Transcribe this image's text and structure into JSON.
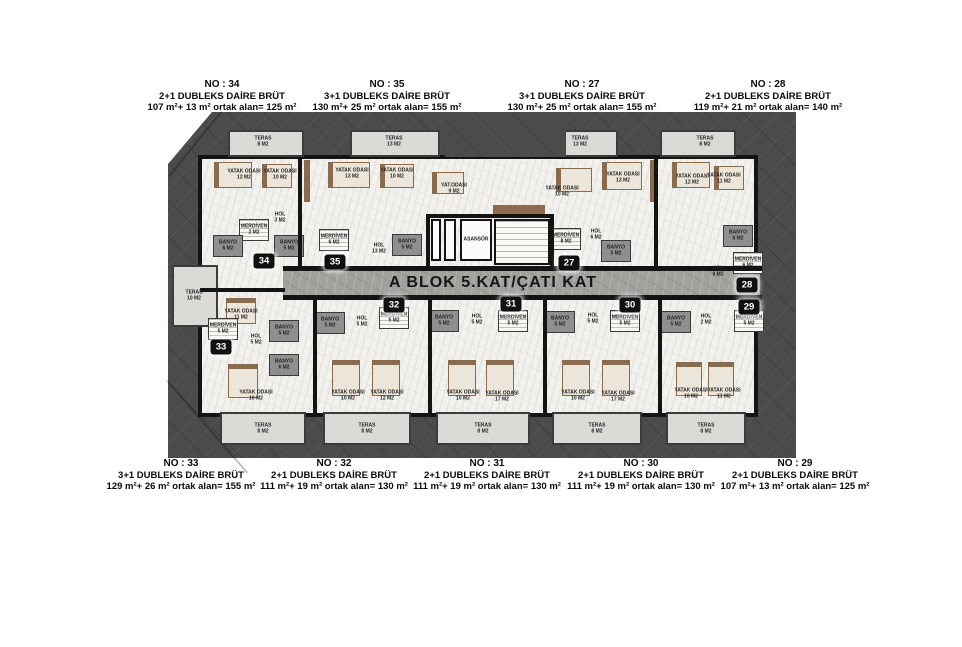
{
  "title": "A BLOK 5.KAT/ÇATI KAT",
  "units_top": [
    {
      "no": "NO : 34",
      "type": "2+1 DUBLEKS DAİRE BRÜT",
      "area": "107 m²+ 13 m² ortak alan= 125 m²",
      "cx": 222
    },
    {
      "no": "NO : 35",
      "type": "3+1 DUBLEKS DAİRE BRÜT",
      "area": "130 m²+ 25 m² ortak alan= 155 m²",
      "cx": 387
    },
    {
      "no": "NO : 27",
      "type": "3+1 DUBLEKS DAİRE BRÜT",
      "area": "130 m²+ 25 m² ortak alan= 155 m²",
      "cx": 582
    },
    {
      "no": "NO : 28",
      "type": "2+1 DUBLEKS DAİRE BRÜT",
      "area": "119 m²+ 21 m² ortak alan= 140 m²",
      "cx": 768
    }
  ],
  "units_bottom": [
    {
      "no": "NO : 33",
      "type": "3+1 DUBLEKS DAİRE BRÜT",
      "area": "129 m²+ 26 m² ortak alan= 155 m²",
      "cx": 181
    },
    {
      "no": "NO : 32",
      "type": "2+1 DUBLEKS DAİRE BRÜT",
      "area": "111 m²+ 19 m² ortak alan= 130 m²",
      "cx": 334
    },
    {
      "no": "NO : 31",
      "type": "2+1 DUBLEKS DAİRE BRÜT",
      "area": "111 m²+ 19 m² ortak alan= 130 m²",
      "cx": 487
    },
    {
      "no": "NO : 30",
      "type": "2+1 DUBLEKS DAİRE BRÜT",
      "area": "111 m²+ 19 m² ortak alan= 130 m²",
      "cx": 641
    },
    {
      "no": "NO : 29",
      "type": "2+1 DUBLEKS DAİRE BRÜT",
      "area": "107 m²+ 13 m² ortak alan= 125 m²",
      "cx": 795
    }
  ],
  "badges": [
    {
      "label": "34",
      "x": 96,
      "y": 149
    },
    {
      "label": "35",
      "x": 167,
      "y": 150
    },
    {
      "label": "27",
      "x": 401,
      "y": 151
    },
    {
      "label": "28",
      "x": 579,
      "y": 173
    },
    {
      "label": "29",
      "x": 581,
      "y": 195
    },
    {
      "label": "30",
      "x": 462,
      "y": 193
    },
    {
      "label": "31",
      "x": 343,
      "y": 192
    },
    {
      "label": "32",
      "x": 226,
      "y": 193
    },
    {
      "label": "33",
      "x": 53,
      "y": 235
    }
  ],
  "rooms": [
    {
      "n": "TERAS",
      "a": "8 M2",
      "x": 95,
      "y": 30
    },
    {
      "n": "YATAK ODASI",
      "a": "12 M2",
      "x": 76,
      "y": 63
    },
    {
      "n": "YATAK ODASI",
      "a": "10 M2",
      "x": 112,
      "y": 63
    },
    {
      "n": "HOL",
      "a": "3 M2",
      "x": 112,
      "y": 106
    },
    {
      "n": "MERDİVEN",
      "a": "2 M2",
      "x": 86,
      "y": 118
    },
    {
      "n": "BANYO",
      "a": "6 M2",
      "x": 60,
      "y": 134
    },
    {
      "n": "BANYO",
      "a": "5 M2",
      "x": 121,
      "y": 134
    },
    {
      "n": "TERAS",
      "a": "13 M2",
      "x": 226,
      "y": 30
    },
    {
      "n": "YATAK ODASI",
      "a": "13 M2",
      "x": 184,
      "y": 62
    },
    {
      "n": "YATAK ODASI",
      "a": "10 M2",
      "x": 229,
      "y": 62
    },
    {
      "n": "YAT.ODASI",
      "a": "9 M2",
      "x": 286,
      "y": 77
    },
    {
      "n": "MERDİVEN",
      "a": "6 M2",
      "x": 166,
      "y": 128
    },
    {
      "n": "HOL",
      "a": "13 M2",
      "x": 211,
      "y": 137
    },
    {
      "n": "BANYO",
      "a": "5 M2",
      "x": 239,
      "y": 133
    },
    {
      "n": "ASANSÖR",
      "a": "",
      "x": 308,
      "y": 128
    },
    {
      "n": "MERDİVEN",
      "a": "8 M2",
      "x": 398,
      "y": 127
    },
    {
      "n": "TERAS",
      "a": "13 M2",
      "x": 412,
      "y": 30
    },
    {
      "n": "YATAK ODASI",
      "a": "10 M2",
      "x": 394,
      "y": 80
    },
    {
      "n": "YATAK ODASI",
      "a": "13 M2",
      "x": 455,
      "y": 66
    },
    {
      "n": "HOL",
      "a": "6 M2",
      "x": 428,
      "y": 123
    },
    {
      "n": "BANYO",
      "a": "5 M2",
      "x": 448,
      "y": 139
    },
    {
      "n": "TERAS",
      "a": "8 M2",
      "x": 537,
      "y": 30
    },
    {
      "n": "YATAK ODASI",
      "a": "12 M2",
      "x": 524,
      "y": 68
    },
    {
      "n": "YATAK ODASI",
      "a": "11 M2",
      "x": 556,
      "y": 67
    },
    {
      "n": "BANYO",
      "a": "6 M2",
      "x": 570,
      "y": 124
    },
    {
      "n": "HOL",
      "a": "8 M2",
      "x": 550,
      "y": 160
    },
    {
      "n": "MERDİVEN",
      "a": "6 M2",
      "x": 580,
      "y": 151
    },
    {
      "n": "MERDİVEN",
      "a": "5 M2",
      "x": 581,
      "y": 209
    },
    {
      "n": "HOL",
      "a": "2 M2",
      "x": 538,
      "y": 208
    },
    {
      "n": "BANYO",
      "a": "5 M2",
      "x": 508,
      "y": 210
    },
    {
      "n": "YATAK ODASI",
      "a": "10 M2",
      "x": 523,
      "y": 282
    },
    {
      "n": "YATAK ODASI",
      "a": "11 M2",
      "x": 556,
      "y": 282
    },
    {
      "n": "TERAS",
      "a": "8 M2",
      "x": 538,
      "y": 317
    },
    {
      "n": "MERDİVEN",
      "a": "5 M2",
      "x": 457,
      "y": 209
    },
    {
      "n": "HOL",
      "a": "5 M2",
      "x": 425,
      "y": 207
    },
    {
      "n": "BANYO",
      "a": "5 M2",
      "x": 392,
      "y": 210
    },
    {
      "n": "YATAK ODASI",
      "a": "10 M2",
      "x": 410,
      "y": 284
    },
    {
      "n": "YATAK ODASI",
      "a": "17 M2",
      "x": 450,
      "y": 285
    },
    {
      "n": "TERAS",
      "a": "8 M2",
      "x": 429,
      "y": 317
    },
    {
      "n": "MERDİVEN",
      "a": "5 M2",
      "x": 345,
      "y": 209
    },
    {
      "n": "HOL",
      "a": "5 M2",
      "x": 309,
      "y": 208
    },
    {
      "n": "BANYO",
      "a": "5 M2",
      "x": 276,
      "y": 209
    },
    {
      "n": "YATAK ODASI",
      "a": "10 M2",
      "x": 295,
      "y": 284
    },
    {
      "n": "YATAK ODASI",
      "a": "17 M2",
      "x": 334,
      "y": 285
    },
    {
      "n": "TERAS",
      "a": "8 M2",
      "x": 315,
      "y": 317
    },
    {
      "n": "MERDİVEN",
      "a": "5 M2",
      "x": 226,
      "y": 206
    },
    {
      "n": "HOL",
      "a": "5 M2",
      "x": 194,
      "y": 210
    },
    {
      "n": "BANYO",
      "a": "5 M2",
      "x": 162,
      "y": 211
    },
    {
      "n": "YATAK ODASI",
      "a": "10 M2",
      "x": 180,
      "y": 284
    },
    {
      "n": "YATAK ODASI",
      "a": "12 M2",
      "x": 219,
      "y": 284
    },
    {
      "n": "TERAS",
      "a": "8 M2",
      "x": 199,
      "y": 317
    },
    {
      "n": "TERAS",
      "a": "10 M2",
      "x": 26,
      "y": 184
    },
    {
      "n": "YATAK ODASI",
      "a": "11 M2",
      "x": 73,
      "y": 203
    },
    {
      "n": "MERDİVEN",
      "a": "5 M2",
      "x": 55,
      "y": 217
    },
    {
      "n": "HOL",
      "a": "5 M2",
      "x": 88,
      "y": 228
    },
    {
      "n": "BANYO",
      "a": "5 M2",
      "x": 116,
      "y": 219
    },
    {
      "n": "BANYO",
      "a": "6 M2",
      "x": 116,
      "y": 253
    },
    {
      "n": "YATAK ODASI",
      "a": "10 M2",
      "x": 88,
      "y": 284
    },
    {
      "n": "TERAS",
      "a": "8 M2",
      "x": 95,
      "y": 317
    }
  ],
  "areas": [
    {
      "t": "terrace",
      "x": 60,
      "y": 18,
      "w": 76,
      "h": 27
    },
    {
      "t": "terrace",
      "x": 182,
      "y": 18,
      "w": 90,
      "h": 27
    },
    {
      "t": "terrace",
      "x": 377,
      "y": 18,
      "w": 73,
      "h": 27
    },
    {
      "t": "terrace",
      "x": 492,
      "y": 18,
      "w": 76,
      "h": 27
    },
    {
      "t": "terrace",
      "x": 4,
      "y": 153,
      "w": 46,
      "h": 62
    },
    {
      "t": "terrace",
      "x": 52,
      "y": 300,
      "w": 86,
      "h": 33
    },
    {
      "t": "terrace",
      "x": 155,
      "y": 300,
      "w": 88,
      "h": 33
    },
    {
      "t": "terrace",
      "x": 268,
      "y": 300,
      "w": 94,
      "h": 33
    },
    {
      "t": "terrace",
      "x": 384,
      "y": 300,
      "w": 90,
      "h": 33
    },
    {
      "t": "terrace",
      "x": 498,
      "y": 300,
      "w": 80,
      "h": 33
    },
    {
      "t": "roofpatch",
      "x": 277,
      "y": 0,
      "w": 121,
      "h": 45
    },
    {
      "t": "corridor",
      "x": 115,
      "y": 158,
      "w": 477,
      "h": 26
    },
    {
      "t": "seam",
      "x": 0,
      "y": 64,
      "w": 84,
      "r": -51
    },
    {
      "t": "seam",
      "x": 0,
      "y": 268,
      "w": 122,
      "r": 49
    }
  ],
  "walls": [
    {
      "x": 115,
      "y": 154,
      "w": 479,
      "h": 5
    },
    {
      "x": 115,
      "y": 183,
      "w": 479,
      "h": 5
    },
    {
      "x": 32,
      "y": 176,
      "w": 85,
      "h": 4
    },
    {
      "x": 130,
      "y": 45,
      "w": 4,
      "h": 109
    },
    {
      "x": 486,
      "y": 45,
      "w": 4,
      "h": 109
    },
    {
      "x": 145,
      "y": 188,
      "w": 4,
      "h": 114
    },
    {
      "x": 260,
      "y": 188,
      "w": 4,
      "h": 114
    },
    {
      "x": 375,
      "y": 188,
      "w": 4,
      "h": 114
    },
    {
      "x": 490,
      "y": 188,
      "w": 4,
      "h": 114
    },
    {
      "x": 258,
      "y": 102,
      "w": 128,
      "h": 4
    },
    {
      "x": 258,
      "y": 102,
      "w": 4,
      "h": 54
    },
    {
      "x": 382,
      "y": 102,
      "w": 4,
      "h": 56
    }
  ],
  "furniture": [
    {
      "t": "shaft",
      "x": 263,
      "y": 107,
      "w": 10,
      "h": 42
    },
    {
      "t": "shaft",
      "x": 276,
      "y": 107,
      "w": 12,
      "h": 42
    },
    {
      "t": "elevator",
      "x": 292,
      "y": 107,
      "w": 32,
      "h": 42
    },
    {
      "t": "stairs_lg",
      "x": 326,
      "y": 107,
      "w": 56,
      "h": 46
    },
    {
      "t": "wood",
      "x": 325,
      "y": 93,
      "w": 52,
      "h": 10
    },
    {
      "t": "wood",
      "x": 136,
      "y": 48,
      "w": 6,
      "h": 42
    },
    {
      "t": "wood",
      "x": 482,
      "y": 48,
      "w": 6,
      "h": 42
    },
    {
      "t": "bed",
      "o": "h",
      "x": 46,
      "y": 50,
      "w": 38,
      "h": 26
    },
    {
      "t": "bed",
      "o": "h",
      "x": 94,
      "y": 52,
      "w": 30,
      "h": 24
    },
    {
      "t": "bed",
      "o": "h",
      "x": 160,
      "y": 50,
      "w": 42,
      "h": 26
    },
    {
      "t": "bed",
      "o": "h",
      "x": 212,
      "y": 52,
      "w": 34,
      "h": 24
    },
    {
      "t": "bed",
      "o": "h",
      "x": 264,
      "y": 60,
      "w": 32,
      "h": 22
    },
    {
      "t": "bed",
      "o": "h",
      "x": 388,
      "y": 56,
      "w": 36,
      "h": 24
    },
    {
      "t": "bed",
      "o": "h",
      "x": 434,
      "y": 50,
      "w": 40,
      "h": 28
    },
    {
      "t": "bed",
      "o": "h",
      "x": 504,
      "y": 50,
      "w": 38,
      "h": 26
    },
    {
      "t": "bed",
      "o": "h",
      "x": 546,
      "y": 54,
      "w": 30,
      "h": 24
    },
    {
      "t": "bed",
      "o": "v",
      "x": 58,
      "y": 186,
      "w": 30,
      "h": 26
    },
    {
      "t": "bed",
      "o": "v",
      "x": 60,
      "y": 252,
      "w": 30,
      "h": 34
    },
    {
      "t": "bed",
      "o": "v",
      "x": 164,
      "y": 248,
      "w": 28,
      "h": 36
    },
    {
      "t": "bed",
      "o": "v",
      "x": 204,
      "y": 248,
      "w": 28,
      "h": 36
    },
    {
      "t": "bed",
      "o": "v",
      "x": 280,
      "y": 248,
      "w": 28,
      "h": 36
    },
    {
      "t": "bed",
      "o": "v",
      "x": 318,
      "y": 248,
      "w": 28,
      "h": 36
    },
    {
      "t": "bed",
      "o": "v",
      "x": 394,
      "y": 248,
      "w": 28,
      "h": 36
    },
    {
      "t": "bed",
      "o": "v",
      "x": 434,
      "y": 248,
      "w": 28,
      "h": 36
    },
    {
      "t": "bed",
      "o": "v",
      "x": 508,
      "y": 250,
      "w": 26,
      "h": 34
    },
    {
      "t": "bed",
      "o": "v",
      "x": 540,
      "y": 250,
      "w": 26,
      "h": 34
    }
  ],
  "colors": {
    "roof": "#4c4b49",
    "wall": "#141414",
    "marble": "#f3f1ed",
    "corridor": "#a3a19e",
    "terrace": "#dcdad7",
    "wood": "#8b6b4e",
    "badge_bg": "#101010",
    "badge_text": "#ffffff"
  }
}
